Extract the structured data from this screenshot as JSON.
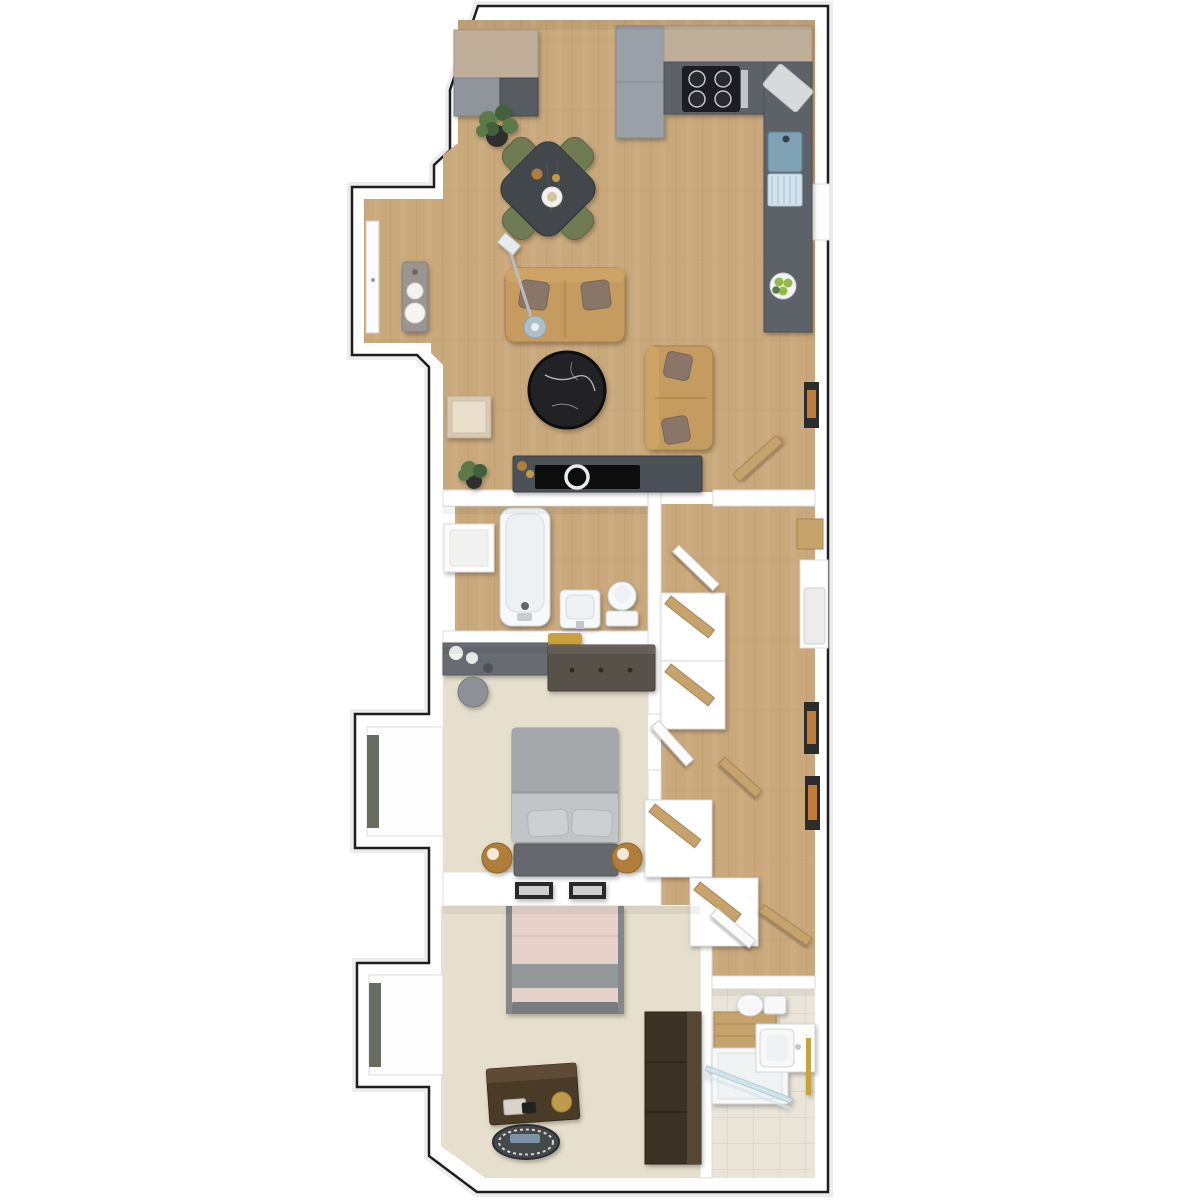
{
  "title": "two-bedroom-apartment-3d-floor-plan",
  "colors": {
    "bg": "#ffffff",
    "outline": "#1e1e1e",
    "wall": "#ffffff",
    "wall_edge": "#dcdcdc",
    "wood": "#c9a87c",
    "wood_line": "#b18a5c",
    "wood_light": "#d3b488",
    "carpet": "#e7dfcd",
    "tile": "#eae5d8",
    "tile_line": "#d9d2c2",
    "counter": "#5d6268",
    "cabinet_tan": "#bfae9a",
    "cabinet_gray": "#8f959b",
    "fridge": "#9aa0a7",
    "stove": "#1b1d20",
    "steel": "#c3c6ca",
    "table": "#43474c",
    "chair_olive": "#6f7a52",
    "sofa": "#c59b60",
    "sofa_edge": "#a87f49",
    "pillow": "#8a7669",
    "marble": "#202327",
    "marble_vein": "#cfd2d6",
    "console": "#4c5157",
    "tv": "#0e0f11",
    "white_fix": "#f7f8f9",
    "fix_edge": "#cfd4d7",
    "vanity_wood": "#57514a",
    "vanity_counter": "#676c72",
    "duvet": "#a9acaf",
    "sheet": "#c2c5c8",
    "headboard": "#65686c",
    "gold": "#c09a4d",
    "brass": "#b07d3a",
    "blush": "#e6d2ca",
    "blush_band": "#94979a",
    "foot": "#797b7e",
    "chest": "#4a3a28",
    "chest_top": "#5f4c35",
    "wardrobe": "#3b3226",
    "wardrobe_face": "#554634",
    "glass": "#cfe3ea",
    "plant": "#5b7a49",
    "plant_dark": "#42603a",
    "pot": "#2e2e2e",
    "fruit": "#92b94a",
    "sink_steel": "#7fa3b5",
    "drainer": "#d3e2ec",
    "frame_dark": "#2c2c2c",
    "art_orange": "#c07c3a",
    "door_white": "#fbfbfb",
    "door_edge": "#cfcfcf",
    "door_wood": "#c6a26d",
    "door_wood_edge": "#a8854f",
    "window_frame": "#676d62",
    "towel_gold": "#c9a23c",
    "stool": "#8d9196",
    "console_gray": "#9a958f"
  },
  "rooms": [
    {
      "id": "entry-vestibule",
      "floor": "wood"
    },
    {
      "id": "kitchen",
      "floor": "wood"
    },
    {
      "id": "dining-area",
      "floor": "wood"
    },
    {
      "id": "living-room",
      "floor": "wood"
    },
    {
      "id": "bathroom",
      "floor": "wood"
    },
    {
      "id": "hallway",
      "floor": "wood"
    },
    {
      "id": "bedroom-1",
      "floor": "carpet"
    },
    {
      "id": "bedroom-2",
      "floor": "carpet"
    },
    {
      "id": "ensuite-bathroom",
      "floor": "tile"
    }
  ],
  "labels": {
    "plan": "3D floor plan of a two-bedroom apartment",
    "vestibule": "Entry vestibule",
    "kitchen": "Kitchen",
    "dining": "Dining area",
    "living": "Living room",
    "bathroom1": "Main bathroom",
    "hallway": "Hallway with closets",
    "bedroom1": "Bedroom 1",
    "bedroom2": "Bedroom 2",
    "bathroom2": "En-suite shower room",
    "closet_top": "Entry closet",
    "fridge": "Refrigerator",
    "cabinets": "Kitchen cabinets",
    "hob": "Gas hob",
    "cutting_board": "Cutting board",
    "kitchen_sink": "Kitchen sink with drainer",
    "fruit_bowl": "Bowl of fruit",
    "dining_table": "Dining table",
    "dining_chair": "Dining chair",
    "houseplant": "Potted plant",
    "entry_door": "Entry door",
    "console_table": "Console table",
    "sofa": "Two-seat sofa",
    "floor_lamp": "Arc floor lamp",
    "coffee_table": "Round marble coffee table",
    "loveseat": "Loveseat",
    "mirror": "Leaning wall mirror",
    "tv_console": "TV console",
    "tv": "Television",
    "bathtub": "Bathtub",
    "washbasin": "Washbasin",
    "toilet": "Toilet",
    "towel": "Towel",
    "wall_shelf": "Wall niche shelf",
    "vanity": "Vanity desk",
    "stool": "Stool",
    "dresser": "Dresser",
    "bed1": "Double bed",
    "bedside_lamp": "Bedside lamp",
    "wall_art": "Framed wall art",
    "bed2": "Double bed",
    "chest": "Storage chest",
    "tray": "Decorative tray",
    "wardrobe": "Wardrobe",
    "shower": "Walk-in shower",
    "towel_rail": "Towel rail",
    "closet": "Closet with shelves",
    "door": "Open door",
    "window": "Window",
    "utility": "Utility cupboard"
  }
}
